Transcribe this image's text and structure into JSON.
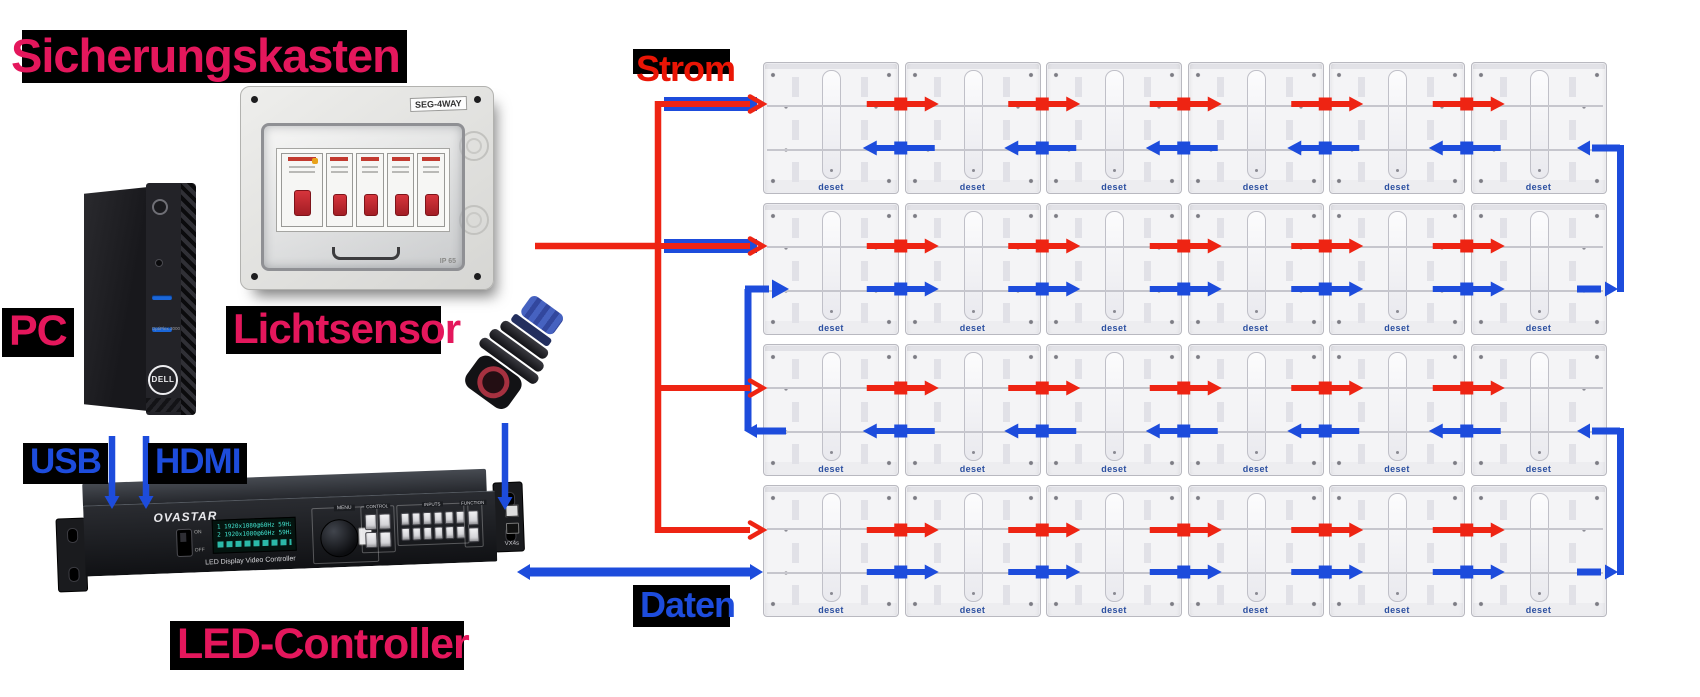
{
  "labels": {
    "sicherungskasten": "Sicherungskasten",
    "pc": "PC",
    "lichtsensor": "Lichtsensor",
    "led_controller": "LED-Controller",
    "strom": "Strom",
    "daten": "Daten",
    "usb": "USB",
    "hdmi": "HDMI"
  },
  "colors": {
    "highlight_text": "#e4175c",
    "power": "#ee2413",
    "data": "#1d4cdc",
    "label_background": "#000000",
    "panel_brand": "#2b4fa0"
  },
  "fusebox": {
    "model_label": "SEG-4WAY",
    "protection_label": "IP 65",
    "breaker_count": 5
  },
  "pc": {
    "brand": "DELL",
    "model": "OptiPlex 3000"
  },
  "controller": {
    "brand": "OVASTAR",
    "caption": "LED Display Video Controller",
    "power_on": "ON",
    "power_off": "OFF",
    "menu_label": "MENU",
    "sections": [
      "CONTROL",
      "INPUTS",
      "FUNCTION"
    ],
    "model": "VX4s",
    "lcd_lines": [
      "1 1920x1080@60Hz 59Hz",
      "2 1920x1080@60Hz 59Hz"
    ]
  },
  "led_wall": {
    "rows": 4,
    "cols": 6,
    "panel_brand": "deset",
    "power_flow_per_row": [
      "right",
      "right",
      "right",
      "right"
    ],
    "data_flow_per_row": [
      "left",
      "right",
      "left",
      "right"
    ],
    "data_chain_order": [
      "row4",
      "row3",
      "row2",
      "row1"
    ]
  }
}
